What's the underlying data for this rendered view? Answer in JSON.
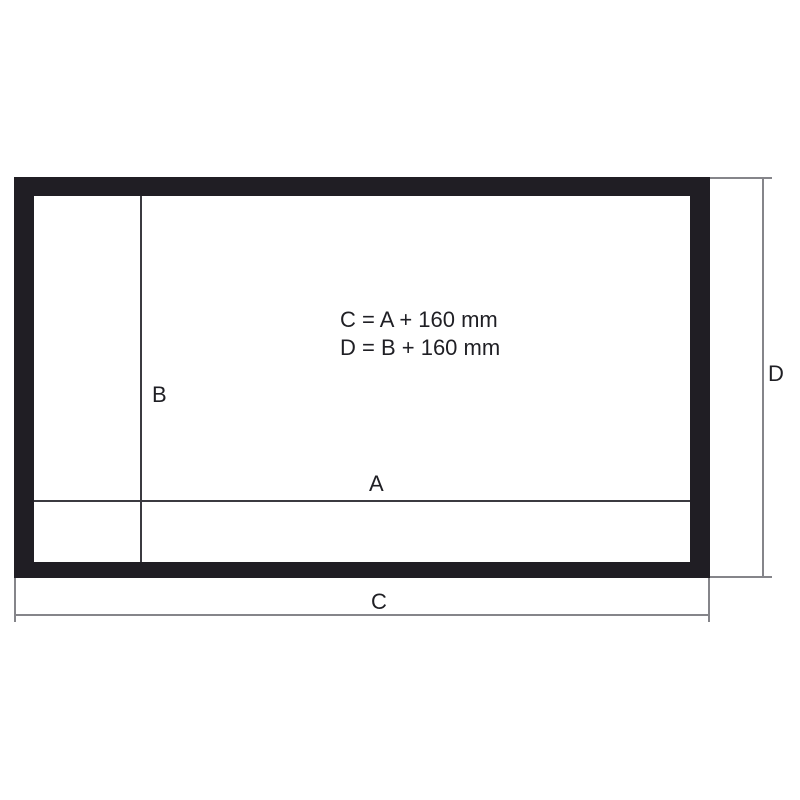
{
  "diagram": {
    "title_hint": "screen-frame-dimension-diagram",
    "formulas": {
      "line1": "C = A + 160 mm",
      "line2": "D = B + 160 mm"
    },
    "labels": {
      "inner_width": "A",
      "inner_height": "B",
      "outer_width": "C",
      "outer_height": "D"
    },
    "colors": {
      "background": "#ffffff",
      "frame": "#201e24",
      "inner_line": "#3b3a40",
      "dimension_line": "#85858a",
      "text": "#1f1f24"
    }
  }
}
